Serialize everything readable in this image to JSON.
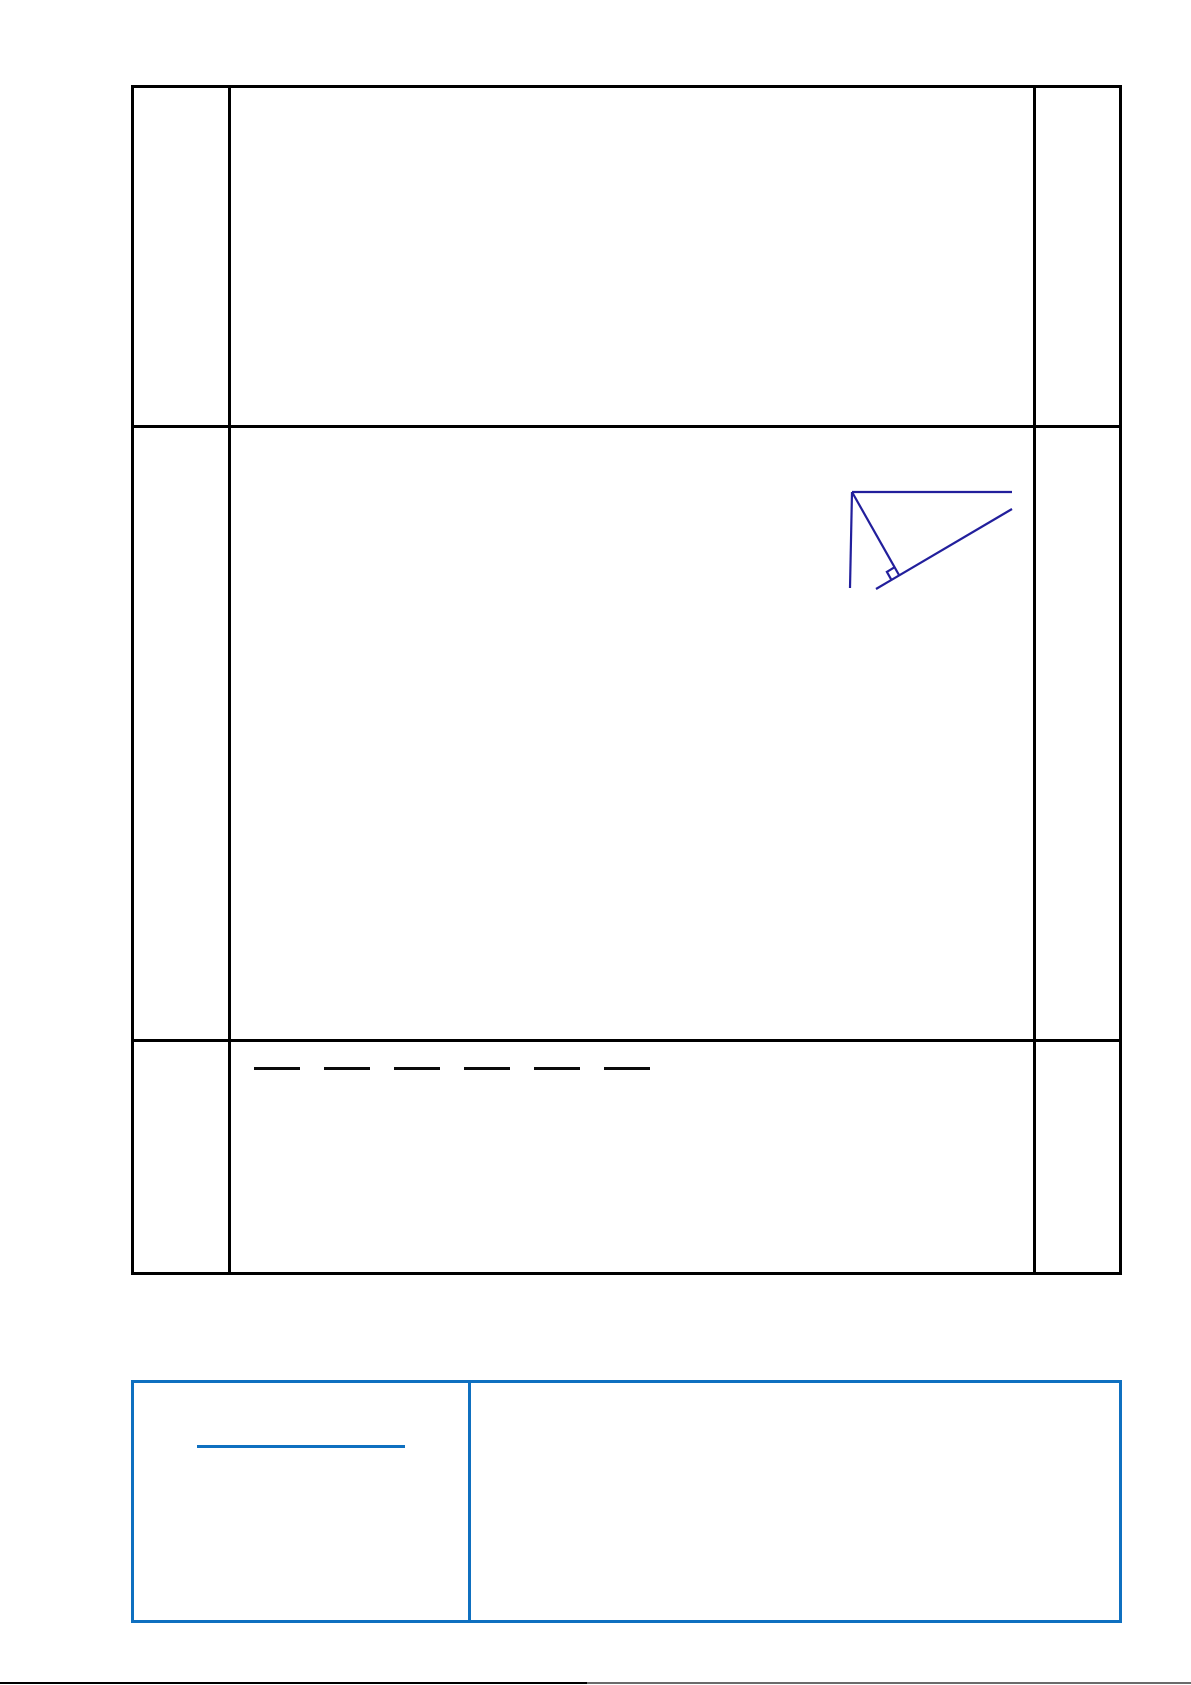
{
  "page": {
    "width_px": 1191,
    "height_px": 1685,
    "background": "#ffffff"
  },
  "worksheet_table": {
    "border_color": "#000000",
    "rows": 3,
    "columns": 3,
    "cells": [
      [
        "",
        "",
        ""
      ],
      [
        "",
        "",
        ""
      ],
      [
        "",
        "",
        ""
      ]
    ]
  },
  "figure": {
    "name": "perpendicular-from-point-to-inclined-line",
    "stroke_color": "#221f9c",
    "elements": [
      "horizontal-ray-from-vertex",
      "vertical-segment-from-vertex",
      "perpendicular-segment-to-line",
      "inclined-line",
      "right-angle-mark"
    ]
  },
  "answer_dashes": {
    "count": 6,
    "color": "#0a0a0a"
  },
  "callout_table": {
    "border_color": "#0f70c0",
    "rows": 1,
    "columns": 2,
    "cells": [
      [
        "",
        ""
      ]
    ],
    "left_cell_underline_color": "#0f70c0"
  },
  "page_bottom_edge": {
    "left_segment_color": "#000000",
    "right_segment_color": "#6b6b6b"
  }
}
